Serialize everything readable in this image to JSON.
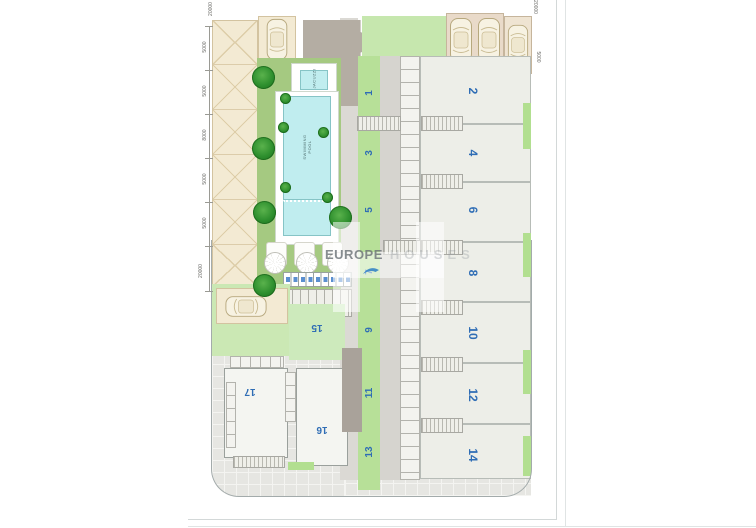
{
  "watermark": {
    "brand_strong": "EUROPE",
    "brand_light": "HOUSES"
  },
  "units": {
    "left": [
      "1",
      "3",
      "5",
      "7",
      "9",
      "11",
      "13"
    ],
    "right": [
      "2",
      "4",
      "6",
      "8",
      "10",
      "12",
      "14"
    ],
    "bottom": [
      "15",
      "16",
      "17"
    ]
  },
  "pool": {
    "jacuzzi_label": "JACUZZI",
    "pool_label": "SWIMMING POOL"
  },
  "dims": {
    "left": [
      "5000",
      "5000",
      "8000",
      "5000",
      "5000"
    ],
    "left_total": "20000",
    "top_left": "20000",
    "top_right": "20000",
    "right_side": "5000"
  },
  "colors": {
    "unit_number": "#2f6db5",
    "pool_water": "#c0edef",
    "garden_green": "#a5c981",
    "path_green": "#b7e098",
    "pale_green": "#cdeabc",
    "carport_beige": "#f3ead3",
    "roof_grey": "#b4ada3"
  }
}
